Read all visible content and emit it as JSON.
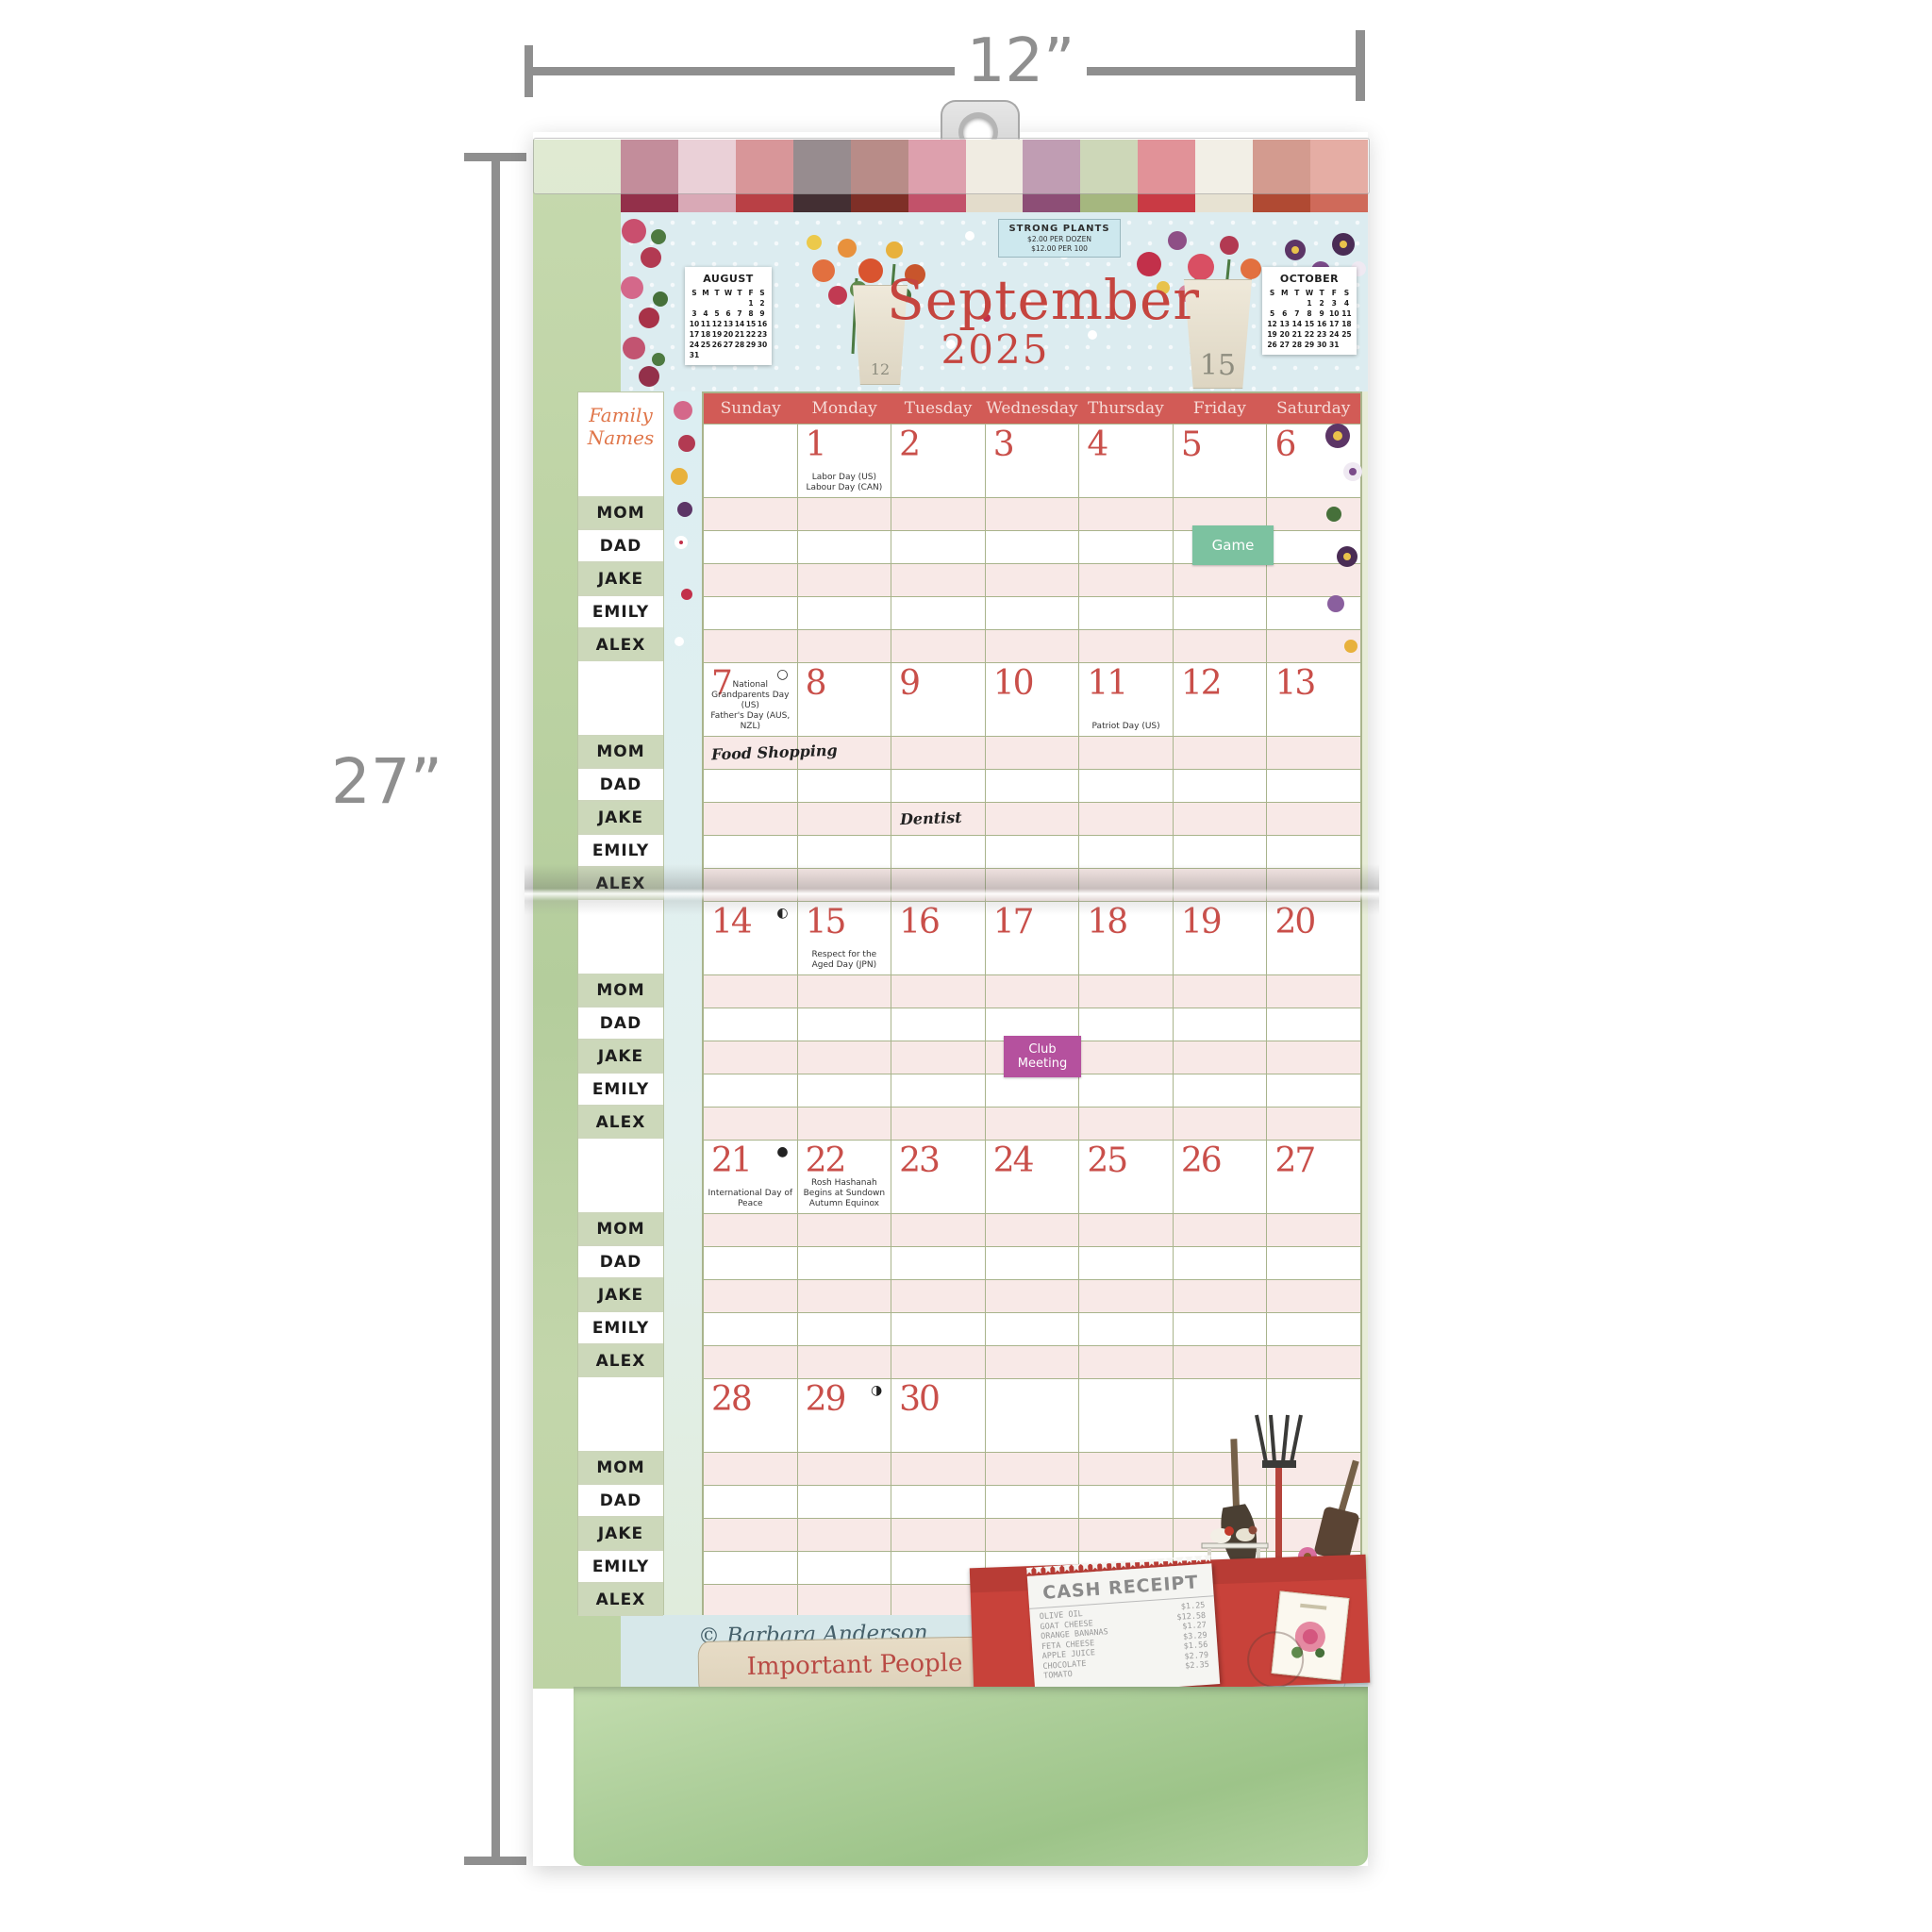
{
  "product_dimensions": {
    "width_label": "12”",
    "height_label": "27”"
  },
  "palette": {
    "accent-red": "#c94f4a",
    "header-red": "#d25b56",
    "stripe-pink": "#f8e9e7",
    "sage": "#a9b48c",
    "green-margin": "#bdd3a4",
    "sidebar-green": "#ccd8ba",
    "header-blue": "#dcecf0",
    "orange-script": "#e0764a",
    "sticker-green": "#7cc2a0",
    "sticker-purple": "#b5519e",
    "envelope-red": "#c8423a",
    "tab-beige": "#ded2bb",
    "tab-blue": "#d6e9ee",
    "pocket-green": "#aecf9b"
  },
  "decor": {
    "patchwork_colors": [
      "#93304a",
      "#d9a9b6",
      "#b94045",
      "#432f33",
      "#7e2f27",
      "#c2526a",
      "#e3dccb",
      "#8d4e76",
      "#a5b77f",
      "#c93a44",
      "#e7e2d2",
      "#b04a33",
      "#cf6a5a"
    ]
  },
  "calendar": {
    "month": "September",
    "year": "2025",
    "sign": {
      "line1": "STRONG PLANTS",
      "line2": "$2.00 PER DOZEN",
      "line3": "$12.00 PER 100"
    },
    "pot_labels": {
      "left": "12",
      "right": "15"
    },
    "mini_calendars": [
      {
        "title": "AUGUST",
        "weekdays": [
          "S",
          "M",
          "T",
          "W",
          "T",
          "F",
          "S"
        ],
        "weeks": [
          [
            "",
            "",
            "",
            "",
            "",
            "1",
            "2"
          ],
          [
            "3",
            "4",
            "5",
            "6",
            "7",
            "8",
            "9"
          ],
          [
            "10",
            "11",
            "12",
            "13",
            "14",
            "15",
            "16"
          ],
          [
            "17",
            "18",
            "19",
            "20",
            "21",
            "22",
            "23"
          ],
          [
            "24",
            "25",
            "26",
            "27",
            "28",
            "29",
            "30"
          ],
          [
            "31",
            "",
            "",
            "",
            "",
            "",
            ""
          ]
        ]
      },
      {
        "title": "OCTOBER",
        "weekdays": [
          "S",
          "M",
          "T",
          "W",
          "T",
          "F",
          "S"
        ],
        "weeks": [
          [
            "",
            "",
            "",
            "1",
            "2",
            "3",
            "4"
          ],
          [
            "5",
            "6",
            "7",
            "8",
            "9",
            "10",
            "11"
          ],
          [
            "12",
            "13",
            "14",
            "15",
            "16",
            "17",
            "18"
          ],
          [
            "19",
            "20",
            "21",
            "22",
            "23",
            "24",
            "25"
          ],
          [
            "26",
            "27",
            "28",
            "29",
            "30",
            "31",
            ""
          ]
        ]
      }
    ],
    "day_headers": [
      "Sunday",
      "Monday",
      "Tuesday",
      "Wednesday",
      "Thursday",
      "Friday",
      "Saturday"
    ],
    "weeks": [
      {
        "days": [
          {
            "date": ""
          },
          {
            "date": "1",
            "holidays": [
              "Labor Day (US)",
              "Labour Day (CAN)"
            ]
          },
          {
            "date": "2"
          },
          {
            "date": "3"
          },
          {
            "date": "4"
          },
          {
            "date": "5"
          },
          {
            "date": "6"
          }
        ]
      },
      {
        "days": [
          {
            "date": "7",
            "moon": "○",
            "holidays": [
              "National Grandparents Day (US)",
              "Father's Day (AUS, NZL)"
            ]
          },
          {
            "date": "8"
          },
          {
            "date": "9"
          },
          {
            "date": "10"
          },
          {
            "date": "11",
            "holidays": [
              "Patriot Day (US)"
            ]
          },
          {
            "date": "12"
          },
          {
            "date": "13"
          }
        ]
      },
      {
        "days": [
          {
            "date": "14",
            "moon": "◐"
          },
          {
            "date": "15",
            "holidays": [
              "Respect for the Aged Day (JPN)"
            ]
          },
          {
            "date": "16"
          },
          {
            "date": "17"
          },
          {
            "date": "18"
          },
          {
            "date": "19"
          },
          {
            "date": "20"
          }
        ]
      },
      {
        "days": [
          {
            "date": "21",
            "moon": "●",
            "holidays": [
              "International Day of Peace"
            ]
          },
          {
            "date": "22",
            "holidays": [
              "Rosh Hashanah Begins at Sundown",
              "Autumn Equinox"
            ]
          },
          {
            "date": "23"
          },
          {
            "date": "24"
          },
          {
            "date": "25"
          },
          {
            "date": "26"
          },
          {
            "date": "27"
          }
        ]
      },
      {
        "days": [
          {
            "date": "28"
          },
          {
            "date": "29",
            "moon": "◑"
          },
          {
            "date": "30"
          },
          {
            "date": ""
          },
          {
            "date": ""
          },
          {
            "date": ""
          },
          {
            "date": ""
          }
        ]
      }
    ],
    "events": [
      {
        "date": 5,
        "member": "DAD",
        "label": "Game",
        "style": "sticker-green"
      },
      {
        "date": 7,
        "member": "MOM",
        "label": "Food Shopping",
        "style": "handwriting"
      },
      {
        "date": 9,
        "member": "JAKE",
        "label": "Dentist",
        "style": "handwriting"
      },
      {
        "date": 17,
        "member": "JAKE",
        "label": "Club Meeting",
        "style": "sticker-purple"
      }
    ],
    "signature": "© Barbara Anderson"
  },
  "sidebar": {
    "title": "Family Names",
    "names": [
      "MOM",
      "DAD",
      "JAKE",
      "EMILY",
      "ALEX"
    ],
    "group_count": 5
  },
  "footer": {
    "tabs": [
      {
        "label": "Important People"
      },
      {
        "label": "Special Dates"
      }
    ],
    "receipt": {
      "title": "CASH RECEIPT",
      "items": [
        {
          "name": "OLIVE OIL",
          "price": "$1.25"
        },
        {
          "name": "GOAT CHEESE",
          "price": "$12.58"
        },
        {
          "name": "ORANGE BANANAS",
          "price": "$1.27"
        },
        {
          "name": "FETA CHEESE",
          "price": "$3.29"
        },
        {
          "name": "APPLE JUICE",
          "price": "$1.56"
        },
        {
          "name": "CHOCOLATE",
          "price": "$2.79"
        },
        {
          "name": "TOMATO",
          "price": "$2.35"
        }
      ]
    }
  }
}
